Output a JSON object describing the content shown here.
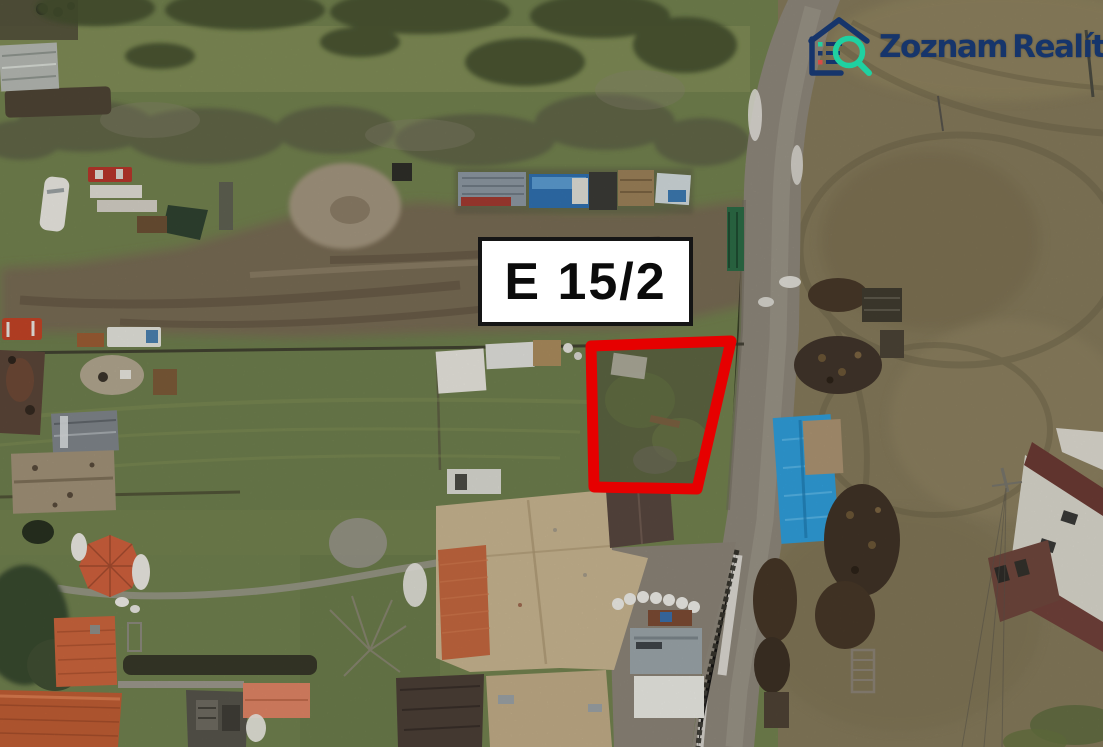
{
  "photo": {
    "type_label": "aerial-drone-photo-of-land-parcel",
    "parcel_label": "E 15/2",
    "outline_color": "#e60000",
    "label_background": "#ffffff",
    "label_border_color": "#151515",
    "label_text_color": "#0b0b0b"
  },
  "watermark": {
    "brand_first": "Zoznam",
    "brand_second": "Realít",
    "brand_suffix": "sk",
    "navy": "#16356b",
    "teal": "#1fd1a1"
  }
}
